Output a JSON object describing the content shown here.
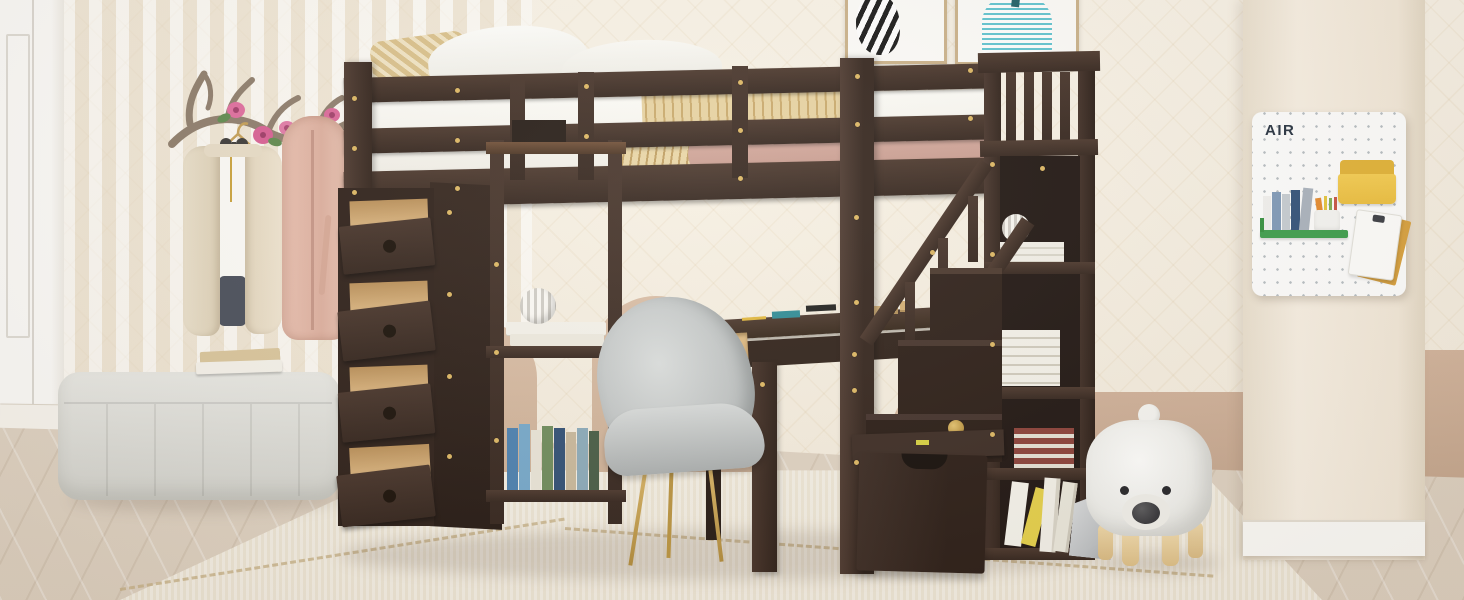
{
  "scene": {
    "type": "furniture-product-photo",
    "description": "Espresso wood twin loft bed with storage staircase, four pull-out drawers, open shelves and built-in desk, styled in a cream kids bedroom",
    "pegboard": {
      "label": "AIR"
    },
    "palette": {
      "espresso": "#3a2a22",
      "espresso_dark": "#241812",
      "drawer_wood": "#dfba85",
      "wall_cream": "#f5eee1",
      "wall_tan": "#cbad95",
      "floor_wood": "#e0d5c5",
      "rug_cream": "#efe9da",
      "bench_gray": "#dedcd6",
      "chair_gray": "#c4c8c8",
      "chair_leg_gold": "#c9a24a",
      "blanket_pink": "#cfa396",
      "throw_gold": "#e6d1a0",
      "art_teal": "#58c0cc",
      "pegboard_yellow": "#efc243",
      "pegboard_green": "#3d9e4c",
      "bear_white": "#f6f6f3",
      "screw_gold": "#dcb662"
    },
    "objects": [
      {
        "name": "loft-bed",
        "description": "espresso loft bed with guard rails and gold screw accents"
      },
      {
        "name": "bedding",
        "description": "white sheets, tan patterned pillows, pink blanket with gold throw"
      },
      {
        "name": "drawer-cabinet",
        "description": "four open drawers with natural wood boxes and round knobs"
      },
      {
        "name": "shelf-unit",
        "description": "open shelves with books and striped sphere vase"
      },
      {
        "name": "desk",
        "description": "built-in desk with natural wood drawer and stationery"
      },
      {
        "name": "chair",
        "description": "gray velvet shell chair with gold metal legs"
      },
      {
        "name": "storage-staircase",
        "description": "staircase with railing, book cubbies and rolling storage box"
      },
      {
        "name": "coat-rack",
        "description": "antler wall rack with flowers, beige cardigan and pink robe"
      },
      {
        "name": "bench",
        "description": "light gray tufted bench with two books"
      },
      {
        "name": "bear-stool",
        "description": "white bear-shaped stool with wooden legs"
      },
      {
        "name": "pegboard",
        "description": "white AIR pegboard with yellow pocket, green shelf, pens and notepad"
      },
      {
        "name": "wall-art",
        "description": "zebra print and teal striped artwork in tan frames"
      }
    ]
  }
}
